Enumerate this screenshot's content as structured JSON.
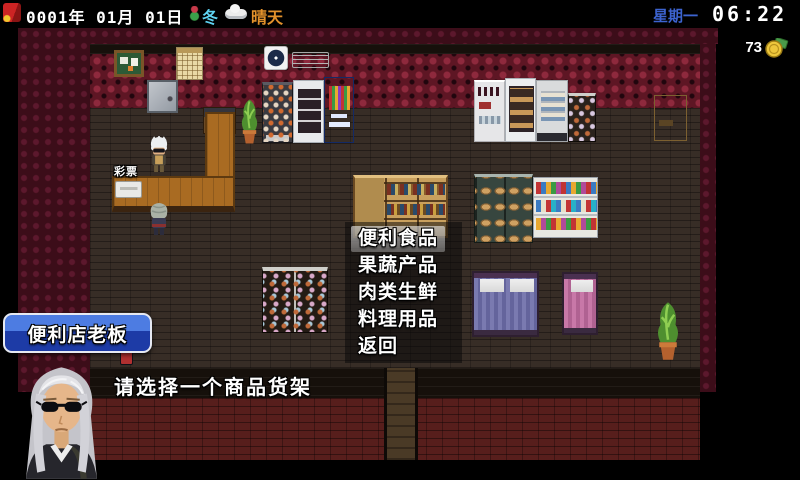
{
  "hud": {
    "date": "0001年 01月 01日",
    "season": "冬",
    "weather": "晴天",
    "weekday": "星期一",
    "time": "06:22",
    "money": "73",
    "icons": {
      "menu": "red-flag-icon",
      "season": "winter-plant-icon",
      "weather": "cloud-icon",
      "money": "gold-coin-icon"
    },
    "colors": {
      "season_text": "#5fd3f2",
      "weather_text": "#e2912b",
      "weekday_text": "#3c63cf",
      "time_text": "#ffffff"
    }
  },
  "menu": {
    "items": [
      {
        "label": "便利食品",
        "selected": true
      },
      {
        "label": "果蔬产品",
        "selected": false
      },
      {
        "label": "肉类生鲜",
        "selected": false
      },
      {
        "label": "料理用品",
        "selected": false
      },
      {
        "label": "返回",
        "selected": false
      }
    ]
  },
  "dialog": {
    "speaker": "便利店老板",
    "text": "请选择一个商品货架"
  },
  "scene": {
    "lottery_label": "彩票",
    "name_box_color": "#2d55c4",
    "wall_color": "#5e1624",
    "floor_color": "#372d26"
  }
}
